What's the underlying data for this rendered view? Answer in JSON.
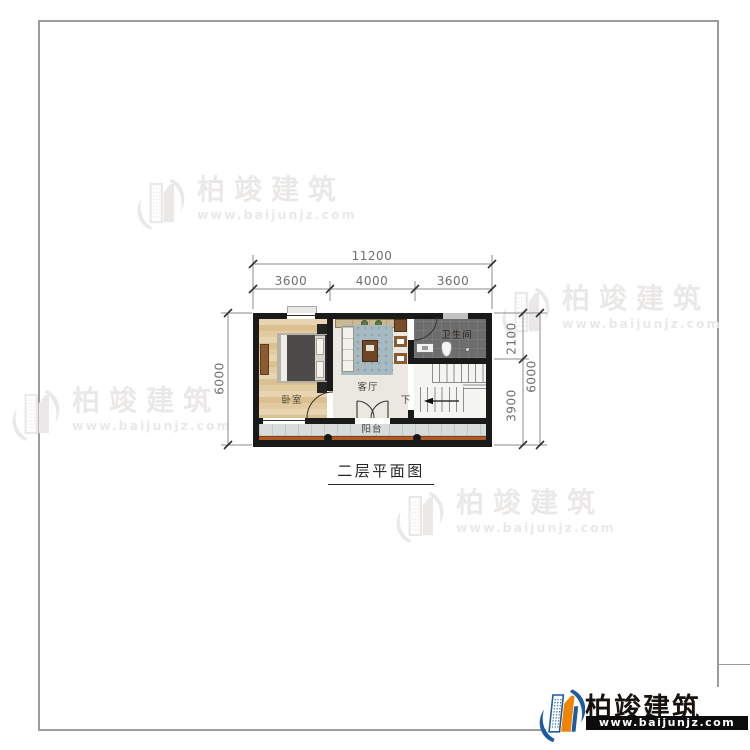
{
  "brand": {
    "name": "柏竣建筑",
    "url": "www.baijunjz.com"
  },
  "plan": {
    "title": "二层平面图",
    "rooms": {
      "bedroom": "卧室",
      "living_room": "客厅",
      "bathroom": "卫生间",
      "balcony": "阳台"
    },
    "stairs": {
      "down_label": "下"
    },
    "dimensions": {
      "top_total": "11200",
      "top_segments": [
        "3600",
        "4000",
        "3600"
      ],
      "left_total": "6000",
      "right_upper": "2100",
      "right_lower": "3900",
      "right_total": "6000"
    }
  },
  "colors": {
    "wall": "#1a1a1a",
    "balcony_railing": "#b05a24",
    "bathroom_floor": "#6d6d6d",
    "logo_blue": "#1d5aa4",
    "logo_orange": "#ef8500",
    "watermark": "#ebe9e7",
    "dim_text": "#6e6e6e"
  }
}
